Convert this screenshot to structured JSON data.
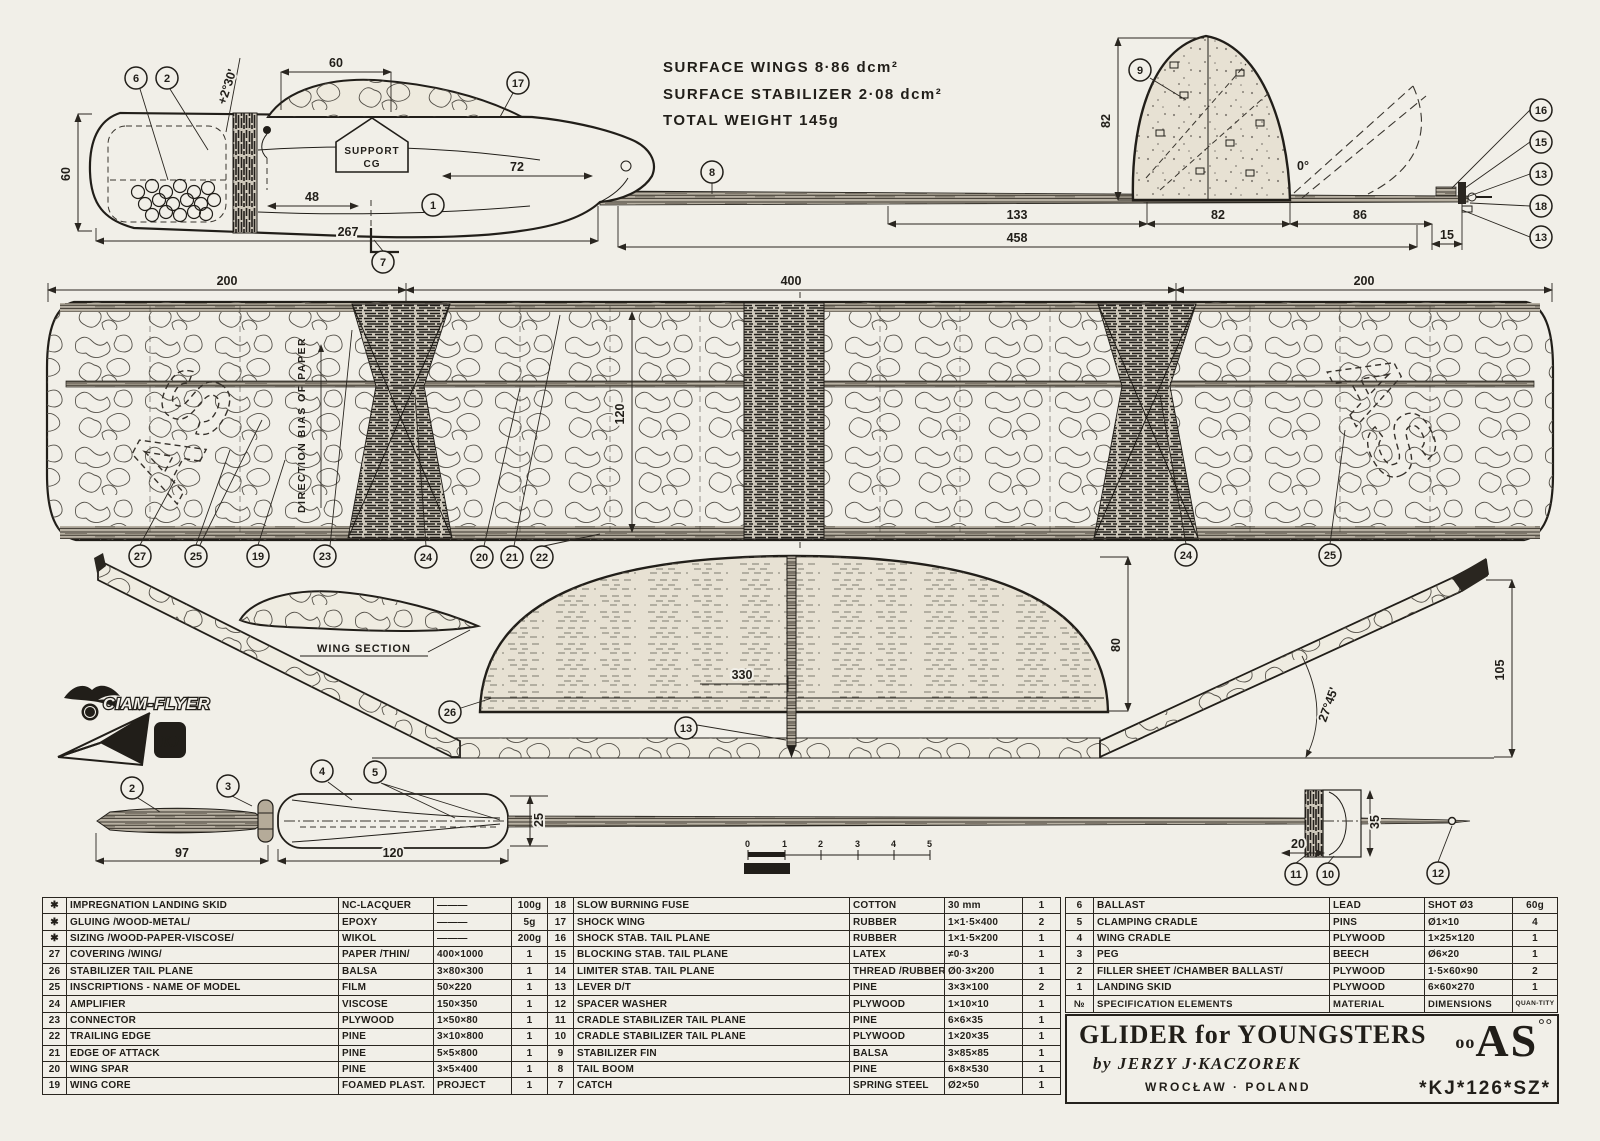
{
  "specs": {
    "line1": "SURFACE WINGS 8·86 dcm²",
    "line2": "SURFACE STABILIZER 2·08 dcm²",
    "line3": "TOTAL WEIGHT 145g"
  },
  "labels": {
    "support_line1": "SUPPORT",
    "support_line2": "CG",
    "wing_section": "WING SECTION",
    "direction_bias": "DIRECTION BIAS OF PAPER",
    "ciam_flyer": "CIAM-FLYER",
    "kj_monogram": "KJ",
    "as_inscription": "AS"
  },
  "scalebar": {
    "ticks": [
      "0",
      "1",
      "2",
      "3",
      "4",
      "5"
    ],
    "label": "MODELL"
  },
  "drawing": {
    "callouts": [
      {
        "n": "6",
        "x": 136,
        "y": 78
      },
      {
        "n": "2",
        "x": 167,
        "y": 78
      },
      {
        "n": "17",
        "x": 518,
        "y": 83
      },
      {
        "n": "1",
        "x": 433,
        "y": 205
      },
      {
        "n": "7",
        "x": 383,
        "y": 262
      },
      {
        "n": "8",
        "x": 712,
        "y": 172
      },
      {
        "n": "9",
        "x": 1140,
        "y": 70
      },
      {
        "n": "16",
        "x": 1541,
        "y": 110
      },
      {
        "n": "15",
        "x": 1541,
        "y": 142
      },
      {
        "n": "13",
        "x": 1541,
        "y": 174
      },
      {
        "n": "18",
        "x": 1541,
        "y": 206
      },
      {
        "n": "13",
        "x": 1541,
        "y": 237
      },
      {
        "n": "27",
        "x": 140,
        "y": 556
      },
      {
        "n": "25",
        "x": 196,
        "y": 556
      },
      {
        "n": "19",
        "x": 258,
        "y": 556
      },
      {
        "n": "23",
        "x": 325,
        "y": 556
      },
      {
        "n": "24",
        "x": 426,
        "y": 557
      },
      {
        "n": "20",
        "x": 482,
        "y": 557
      },
      {
        "n": "21",
        "x": 512,
        "y": 557
      },
      {
        "n": "22",
        "x": 542,
        "y": 557
      },
      {
        "n": "24",
        "x": 1186,
        "y": 555
      },
      {
        "n": "25",
        "x": 1330,
        "y": 555
      },
      {
        "n": "26",
        "x": 450,
        "y": 712
      },
      {
        "n": "13",
        "x": 686,
        "y": 728
      },
      {
        "n": "2",
        "x": 132,
        "y": 788
      },
      {
        "n": "3",
        "x": 228,
        "y": 786
      },
      {
        "n": "4",
        "x": 322,
        "y": 771
      },
      {
        "n": "5",
        "x": 375,
        "y": 772
      },
      {
        "n": "11",
        "x": 1296,
        "y": 874
      },
      {
        "n": "10",
        "x": 1328,
        "y": 874
      },
      {
        "n": "12",
        "x": 1438,
        "y": 873
      }
    ],
    "dimensions": [
      {
        "t": "60",
        "x": 336,
        "y": 67
      },
      {
        "t": "+2°30'",
        "x": 231,
        "y": 88,
        "r": -72
      },
      {
        "t": "60",
        "x": 70,
        "y": 174,
        "r": -90
      },
      {
        "t": "48",
        "x": 312,
        "y": 201
      },
      {
        "t": "72",
        "x": 517,
        "y": 171
      },
      {
        "t": "267",
        "x": 348,
        "y": 236
      },
      {
        "t": "133",
        "x": 1017,
        "y": 219
      },
      {
        "t": "82",
        "x": 1218,
        "y": 219
      },
      {
        "t": "86",
        "x": 1360,
        "y": 219
      },
      {
        "t": "458",
        "x": 1017,
        "y": 242
      },
      {
        "t": "15",
        "x": 1447,
        "y": 239
      },
      {
        "t": "82",
        "x": 1110,
        "y": 121,
        "r": -90
      },
      {
        "t": "0°",
        "x": 1303,
        "y": 170
      },
      {
        "t": "200",
        "x": 227,
        "y": 285
      },
      {
        "t": "400",
        "x": 791,
        "y": 285
      },
      {
        "t": "200",
        "x": 1364,
        "y": 285
      },
      {
        "t": "120",
        "x": 624,
        "y": 414,
        "r": -90
      },
      {
        "t": "330",
        "x": 742,
        "y": 679
      },
      {
        "t": "80",
        "x": 1120,
        "y": 645,
        "r": -90
      },
      {
        "t": "27°45'",
        "x": 1332,
        "y": 706,
        "r": -70
      },
      {
        "t": "105",
        "x": 1504,
        "y": 670,
        "r": -90
      },
      {
        "t": "97",
        "x": 182,
        "y": 857
      },
      {
        "t": "120",
        "x": 393,
        "y": 857
      },
      {
        "t": "25",
        "x": 543,
        "y": 820,
        "r": -90
      },
      {
        "t": "20",
        "x": 1298,
        "y": 848
      },
      {
        "t": "35",
        "x": 1379,
        "y": 822,
        "r": -90
      }
    ]
  },
  "tables": {
    "left": {
      "rows": [
        [
          "✱",
          "IMPREGNATION LANDING SKID",
          "NC-LACQUER",
          "———",
          "100g"
        ],
        [
          "✱",
          "GLUING /WOOD-METAL/",
          "EPOXY",
          "———",
          "5g"
        ],
        [
          "✱",
          "SIZING /WOOD-PAPER-VISCOSE/",
          "WIKOL",
          "———",
          "200g"
        ],
        [
          "27",
          "COVERING /WING/",
          "PAPER /THIN/",
          "400×1000",
          "1"
        ],
        [
          "26",
          "STABILIZER TAIL PLANE",
          "BALSA",
          "3×80×300",
          "1"
        ],
        [
          "25",
          "INSCRIPTIONS - NAME OF MODEL",
          "FILM",
          "50×220",
          "1"
        ],
        [
          "24",
          "AMPLIFIER",
          "VISCOSE",
          "150×350",
          "1"
        ],
        [
          "23",
          "CONNECTOR",
          "PLYWOOD",
          "1×50×80",
          "1"
        ],
        [
          "22",
          "TRAILING EDGE",
          "PINE",
          "3×10×800",
          "1"
        ],
        [
          "21",
          "EDGE OF ATTACK",
          "PINE",
          "5×5×800",
          "1"
        ],
        [
          "20",
          "WING SPAR",
          "PINE",
          "3×5×400",
          "1"
        ],
        [
          "19",
          "WING CORE",
          "FOAMED PLAST.",
          "PROJECT",
          "1"
        ]
      ]
    },
    "middle": {
      "rows": [
        [
          "18",
          "SLOW BURNING FUSE",
          "COTTON",
          "30 mm",
          "1"
        ],
        [
          "17",
          "SHOCK WING",
          "RUBBER",
          "1×1·5×400",
          "2"
        ],
        [
          "16",
          "SHOCK STAB. TAIL PLANE",
          "RUBBER",
          "1×1·5×200",
          "1"
        ],
        [
          "15",
          "BLOCKING STAB. TAIL PLANE",
          "LATEX",
          "≠0·3",
          "1"
        ],
        [
          "14",
          "LIMITER STAB. TAIL PLANE",
          "THREAD /RUBBER/",
          "Ø0·3×200",
          "1"
        ],
        [
          "13",
          "LEVER D/T",
          "PINE",
          "3×3×100",
          "2"
        ],
        [
          "12",
          "SPACER WASHER",
          "PLYWOOD",
          "1×10×10",
          "1"
        ],
        [
          "11",
          "CRADLE STABILIZER TAIL PLANE",
          "PINE",
          "6×6×35",
          "1"
        ],
        [
          "10",
          "CRADLE STABILIZER TAIL PLANE",
          "PLYWOOD",
          "1×20×35",
          "1"
        ],
        [
          "9",
          "STABILIZER FIN",
          "BALSA",
          "3×85×85",
          "1"
        ],
        [
          "8",
          "TAIL BOOM",
          "PINE",
          "6×8×530",
          "1"
        ],
        [
          "7",
          "CATCH",
          "SPRING STEEL",
          "Ø2×50",
          "1"
        ]
      ]
    },
    "right": {
      "rows": [
        [
          "6",
          "BALLAST",
          "LEAD",
          "SHOT Ø3",
          "60g"
        ],
        [
          "5",
          "CLAMPING CRADLE",
          "PINS",
          "Ø1×10",
          "4"
        ],
        [
          "4",
          "WING CRADLE",
          "PLYWOOD",
          "1×25×120",
          "1"
        ],
        [
          "3",
          "PEG",
          "BEECH",
          "Ø6×20",
          "1"
        ],
        [
          "2",
          "FILLER SHEET /CHAMBER BALLAST/",
          "PLYWOOD",
          "1·5×60×90",
          "2"
        ],
        [
          "1",
          "LANDING SKID",
          "PLYWOOD",
          "6×60×270",
          "1"
        ]
      ],
      "header": [
        "№",
        "SPECIFICATION ELEMENTS",
        "MATERIAL",
        "DIMENSIONS",
        "QUAN-TITY"
      ]
    }
  },
  "titleblock": {
    "title": "GLIDER for YOUNGSTERS",
    "by": "by JERZY J·KACZOREK",
    "place": "WROCŁAW · POLAND",
    "code": "*KJ*126*SZ*",
    "logo_prefix": "oo",
    "logo_text": "AS",
    "logo_suffix": "°°"
  }
}
